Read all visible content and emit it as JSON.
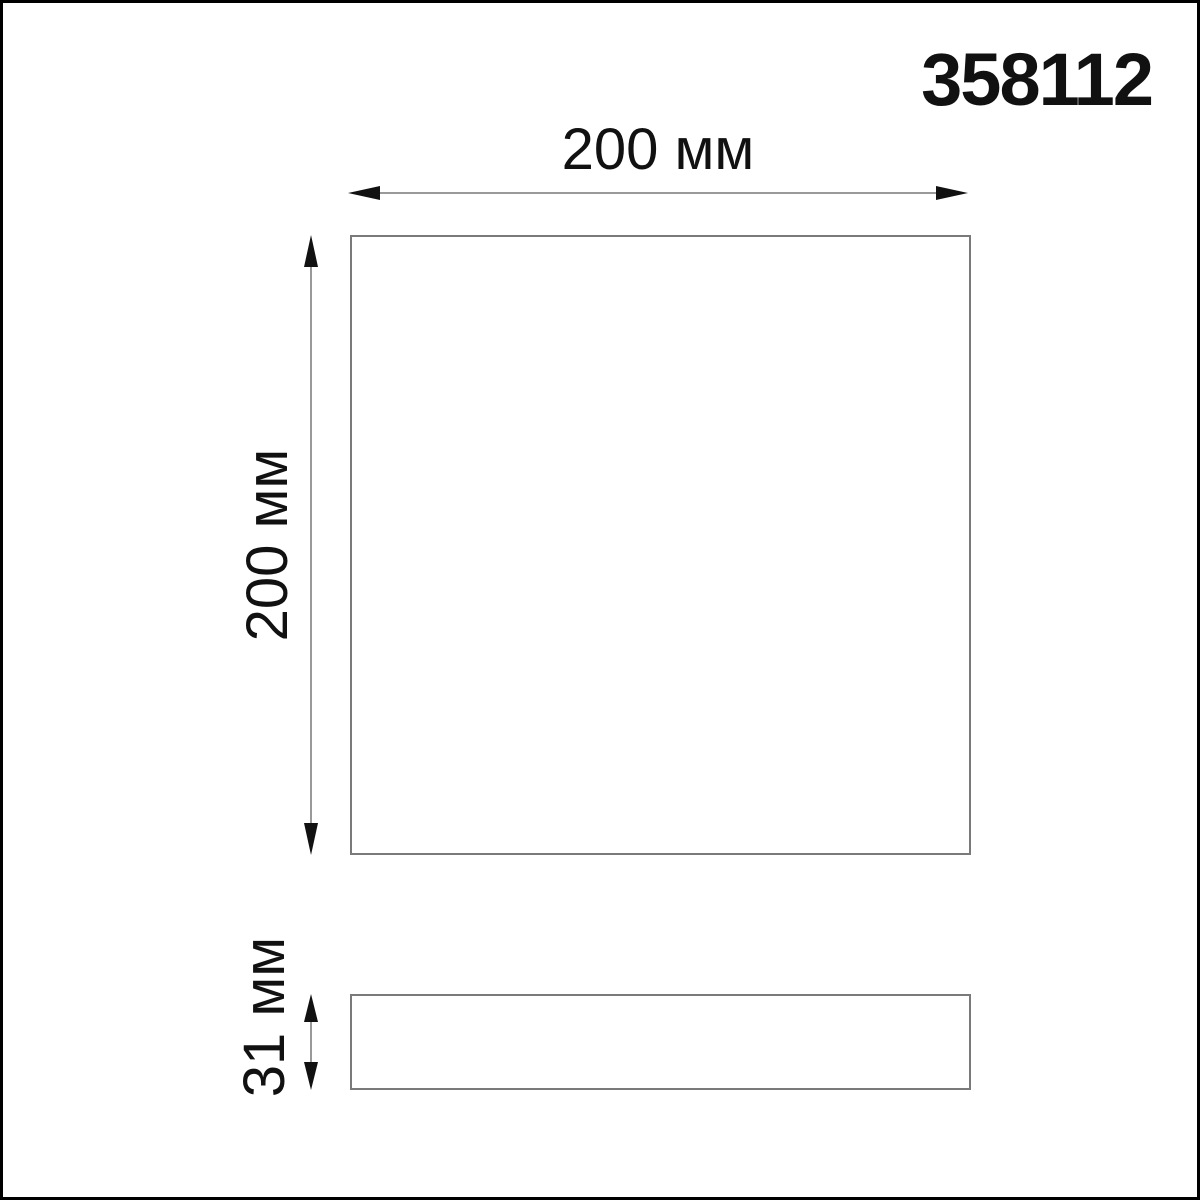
{
  "part_number": "358112",
  "dimensions": {
    "width_label": "200 мм",
    "height_label": "200 мм",
    "depth_label": "31 мм"
  },
  "colors": {
    "background": "#ffffff",
    "frame": "#000000",
    "text": "#111111",
    "outline": "#7a7a7a",
    "dimension_line": "#999999",
    "arrowhead": "#111111"
  }
}
